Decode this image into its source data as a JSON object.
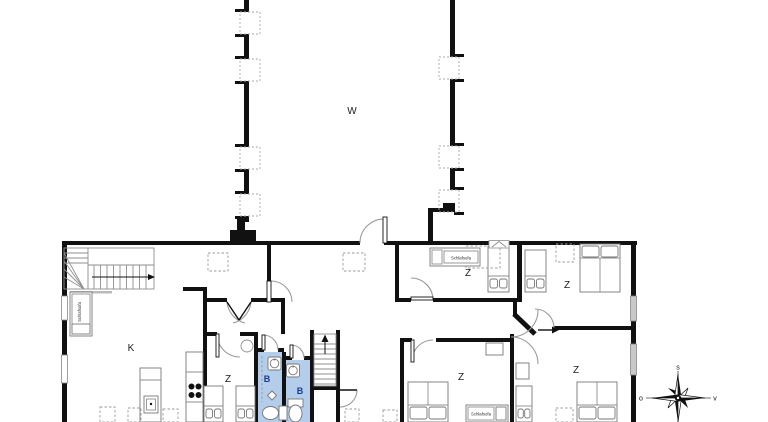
{
  "colors": {
    "wall": "#111111",
    "bath_fill": "#b3cdea",
    "bath_label": "#1a3a8c",
    "window_gray": "#c9c9c9"
  },
  "rooms": [
    {
      "id": "hall-w",
      "label": "W"
    },
    {
      "id": "kitchen-k",
      "label": "K"
    },
    {
      "id": "bedroom-small",
      "label": "Z"
    },
    {
      "id": "bedroom-top-middle",
      "label": "Z"
    },
    {
      "id": "bedroom-top-right",
      "label": "Z"
    },
    {
      "id": "bedroom-bottom-center",
      "label": "Z"
    },
    {
      "id": "bedroom-bottom-right",
      "label": "Z"
    },
    {
      "id": "bathroom-left",
      "label": "B"
    },
    {
      "id": "bathroom-right",
      "label": "B"
    }
  ],
  "furniture": {
    "sofa_labels": [
      "Schlafsofa",
      "Schlafsofa",
      "Schlafsofa"
    ]
  },
  "compass": {
    "top": "s",
    "left": "o",
    "right": "v"
  }
}
